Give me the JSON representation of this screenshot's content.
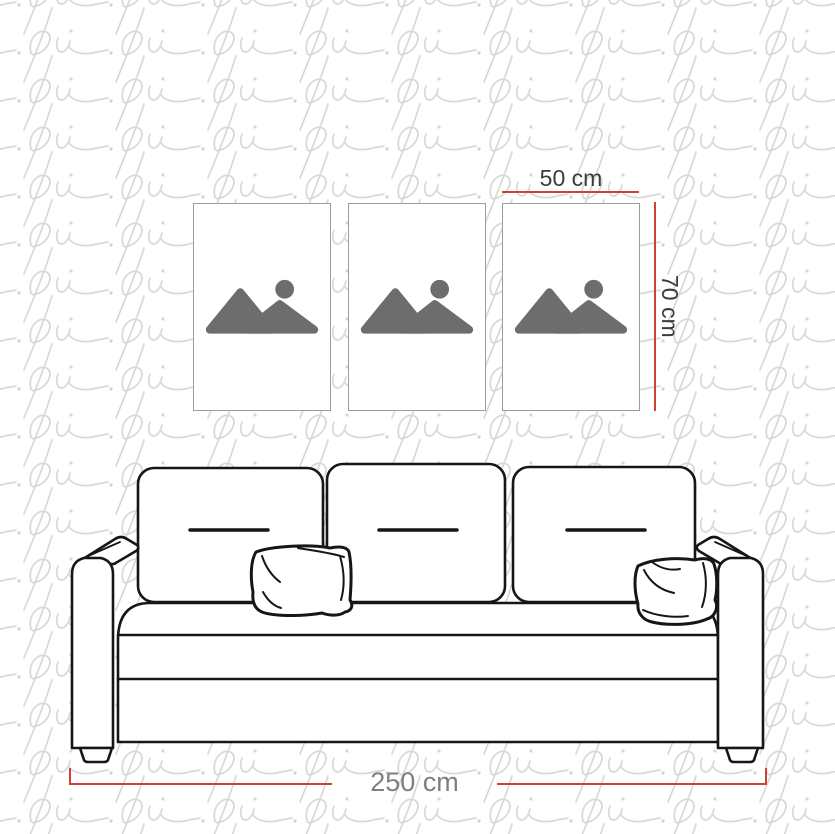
{
  "page": {
    "type": "wall-art-size-guide-diagram",
    "background": "#ffffff",
    "watermark": {
      "glyph": "pi",
      "color": "#d8d8d8"
    }
  },
  "colors": {
    "dimension_red": "#cb4337",
    "dark_label": "#3b3b3b",
    "muted_label": "#7f7f7f",
    "frame_border": "#9c9c9c",
    "placeholder_icon_gray": "#6d6d6d",
    "sofa_line_black": "#161616"
  },
  "dimensions": {
    "frame_width_label": "50 cm",
    "frame_height_label": "70 cm",
    "sofa_width_label": "250 cm"
  },
  "frames": [
    {
      "id": "frame-1",
      "icon": "image-placeholder-icon"
    },
    {
      "id": "frame-2",
      "icon": "image-placeholder-icon"
    },
    {
      "id": "frame-3",
      "icon": "image-placeholder-icon"
    }
  ],
  "sofa": {
    "illustration": "sofa-line-drawing",
    "back_cushion_count": 3,
    "throw_pillow_count": 2
  }
}
